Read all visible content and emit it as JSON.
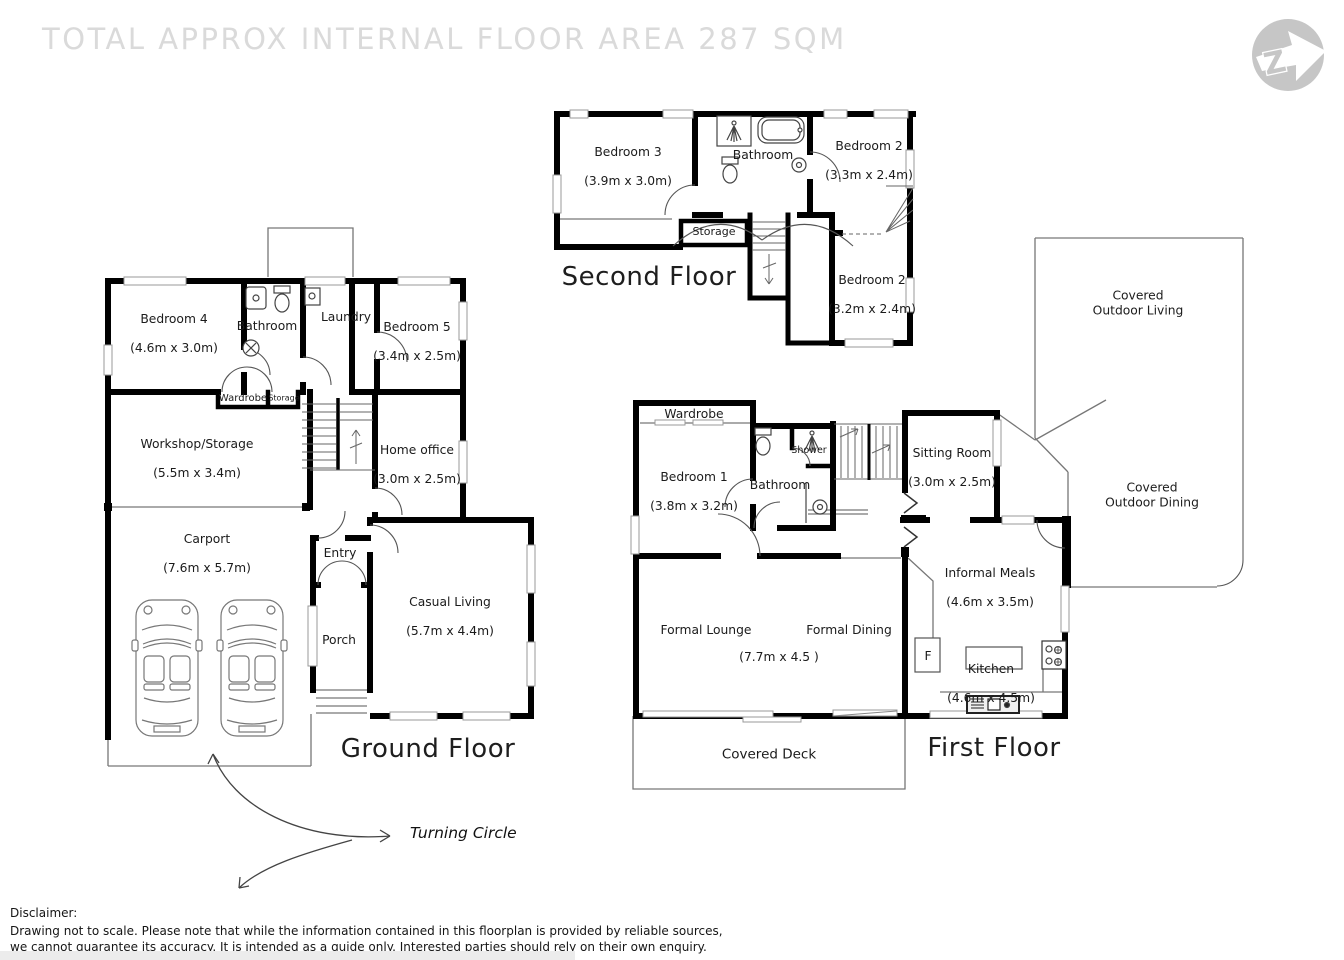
{
  "title": "TOTAL APPROX INTERNAL FLOOR AREA 287 SQM",
  "compass": {
    "letter": "Z"
  },
  "floors": {
    "ground": {
      "label": "Ground Floor",
      "rooms": {
        "bedroom4": {
          "name": "Bedroom 4",
          "dims": "(4.6m x 3.0m)"
        },
        "bathroom": {
          "name": "Bathroom"
        },
        "laundry": {
          "name": "Laundry"
        },
        "bedroom5": {
          "name": "Bedroom 5",
          "dims": "(3.4m x 2.5m)"
        },
        "wardrobe": {
          "name": "Wardrobe"
        },
        "storage": {
          "name": "Storage"
        },
        "workshop": {
          "name": "Workshop/Storage",
          "dims": "(5.5m x 3.4m)"
        },
        "home_office": {
          "name": "Home office",
          "dims": "(3.0m x 2.5m)"
        },
        "carport": {
          "name": "Carport",
          "dims": "(7.6m x 5.7m)"
        },
        "entry": {
          "name": "Entry"
        },
        "porch": {
          "name": "Porch"
        },
        "casual_living": {
          "name": "Casual Living",
          "dims": "(5.7m x 4.4m)"
        }
      }
    },
    "second": {
      "label": "Second Floor",
      "rooms": {
        "bedroom3": {
          "name": "Bedroom 3",
          "dims": "(3.9m x 3.0m)"
        },
        "bathroom": {
          "name": "Bathroom"
        },
        "bedroom2a": {
          "name": "Bedroom 2",
          "dims": "(3.3m x 2.4m)"
        },
        "storage": {
          "name": "Storage"
        },
        "bedroom2b": {
          "name": "Bedroom 2",
          "dims": "(3.2m x 2.4m)"
        }
      }
    },
    "first": {
      "label": "First Floor",
      "rooms": {
        "wardrobe": {
          "name": "Wardrobe"
        },
        "bedroom1": {
          "name": "Bedroom 1",
          "dims": "(3.8m x 3.2m)"
        },
        "bathroom": {
          "name": "Bathroom"
        },
        "shower": {
          "name": "Shower"
        },
        "sitting_room": {
          "name": "Sitting Room",
          "dims": "(3.0m x 2.5m)"
        },
        "covered_outdoor_living": {
          "name": "Covered\nOutdoor Living"
        },
        "covered_outdoor_dining": {
          "name": "Covered\nOutdoor Dining"
        },
        "informal_meals": {
          "name": "Informal Meals",
          "dims": "(4.6m x 3.5m)"
        },
        "formal_lounge": {
          "name": "Formal Lounge"
        },
        "formal_dining": {
          "name": "Formal Dining"
        },
        "lounge_dining_dims": {
          "dims": "(7.7m x 4.5 )"
        },
        "fridge": {
          "name": "F"
        },
        "kitchen": {
          "name": "Kitchen",
          "dims": "(4.6m x 4.5m)"
        },
        "covered_deck": {
          "name": "Covered Deck"
        }
      }
    }
  },
  "annotations": {
    "turning_circle": "Turning Circle"
  },
  "disclaimer": {
    "heading": "Disclaimer:",
    "line1": "Drawing not to scale. Please note that while the information contained in this floorplan is provided by reliable sources,",
    "line2": "we cannot guarantee its accuracy. It is intended as a guide only. Interested parties should rely on their own enquiry."
  }
}
